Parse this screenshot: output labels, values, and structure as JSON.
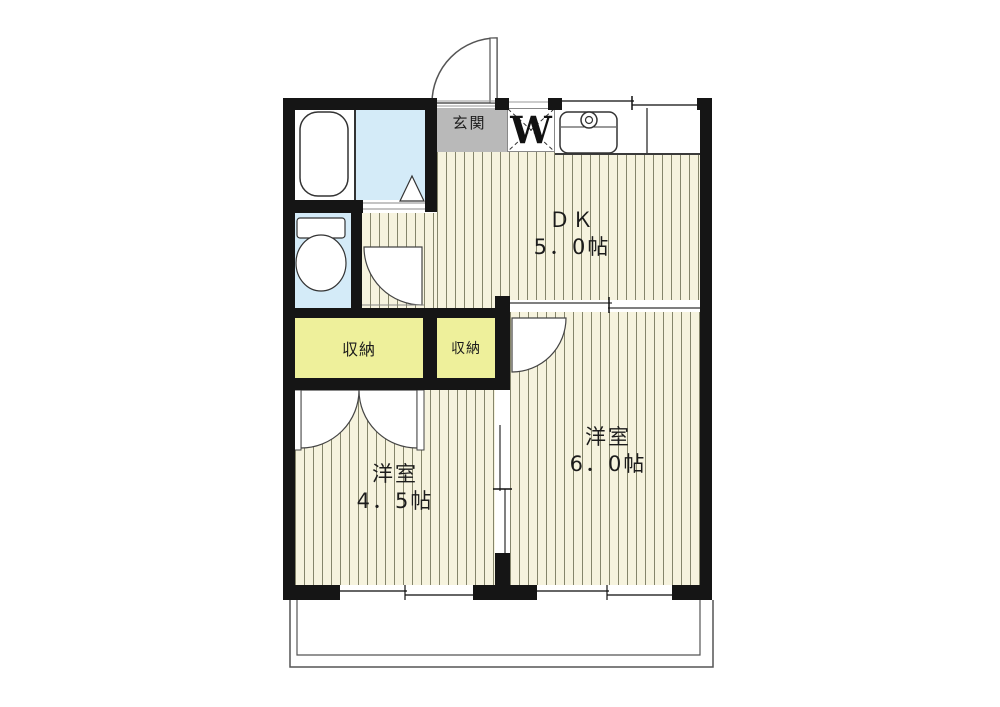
{
  "plan_type": "apartment-floor-plan",
  "rooms": {
    "dk": {
      "name": "ＤＫ",
      "size": "5．0帖"
    },
    "western_6": {
      "name": "洋室",
      "size": "6．0帖"
    },
    "western_45": {
      "name": "洋室",
      "size": "4．5帖"
    }
  },
  "labels": {
    "entrance": "玄関",
    "laundry": "W",
    "closet_left": "収納",
    "closet_right": "収納"
  },
  "colors": {
    "wall": "#151515",
    "floor_background": "#f6f3de",
    "floor_hatch_line": "#85856b",
    "closet_yellow": "#eef09b",
    "wet_area_blue": "#d4ebf8",
    "entrance_gray": "#b9b9b9"
  }
}
